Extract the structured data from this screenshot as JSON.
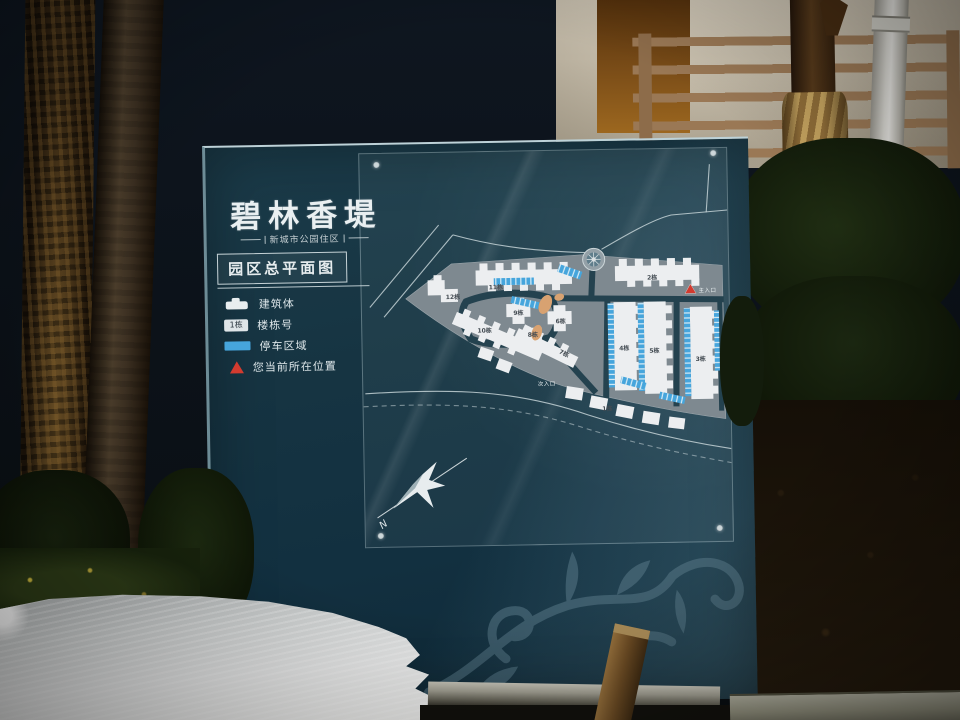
{
  "sign": {
    "title": "碧林香堤",
    "subtitle": "新城市公园住区",
    "plan_label": "园区总平面图",
    "legend": [
      {
        "label": "建筑体"
      },
      {
        "label": "楼栋号",
        "sample": "1栋"
      },
      {
        "label": "停车区域"
      },
      {
        "label": "您当前所在位置"
      }
    ],
    "compass": {
      "north_label": "N"
    },
    "map": {
      "entrances": [
        {
          "label": "主入口"
        },
        {
          "label": "次入口"
        }
      ],
      "buildings": [
        {
          "label": "1栋"
        },
        {
          "label": "2栋"
        },
        {
          "label": "3栋"
        },
        {
          "label": "4栋"
        },
        {
          "label": "5栋"
        },
        {
          "label": "6栋"
        },
        {
          "label": "7栋"
        },
        {
          "label": "8栋"
        },
        {
          "label": "9栋"
        },
        {
          "label": "10栋"
        },
        {
          "label": "11栋"
        },
        {
          "label": "12栋"
        }
      ]
    },
    "colors": {
      "panel": "#16323e",
      "parcel": "#7e8990",
      "building": "#eceef0",
      "parking": "#46a5dc",
      "marker": "#d23b2f",
      "landscape": "#d8a271"
    }
  }
}
